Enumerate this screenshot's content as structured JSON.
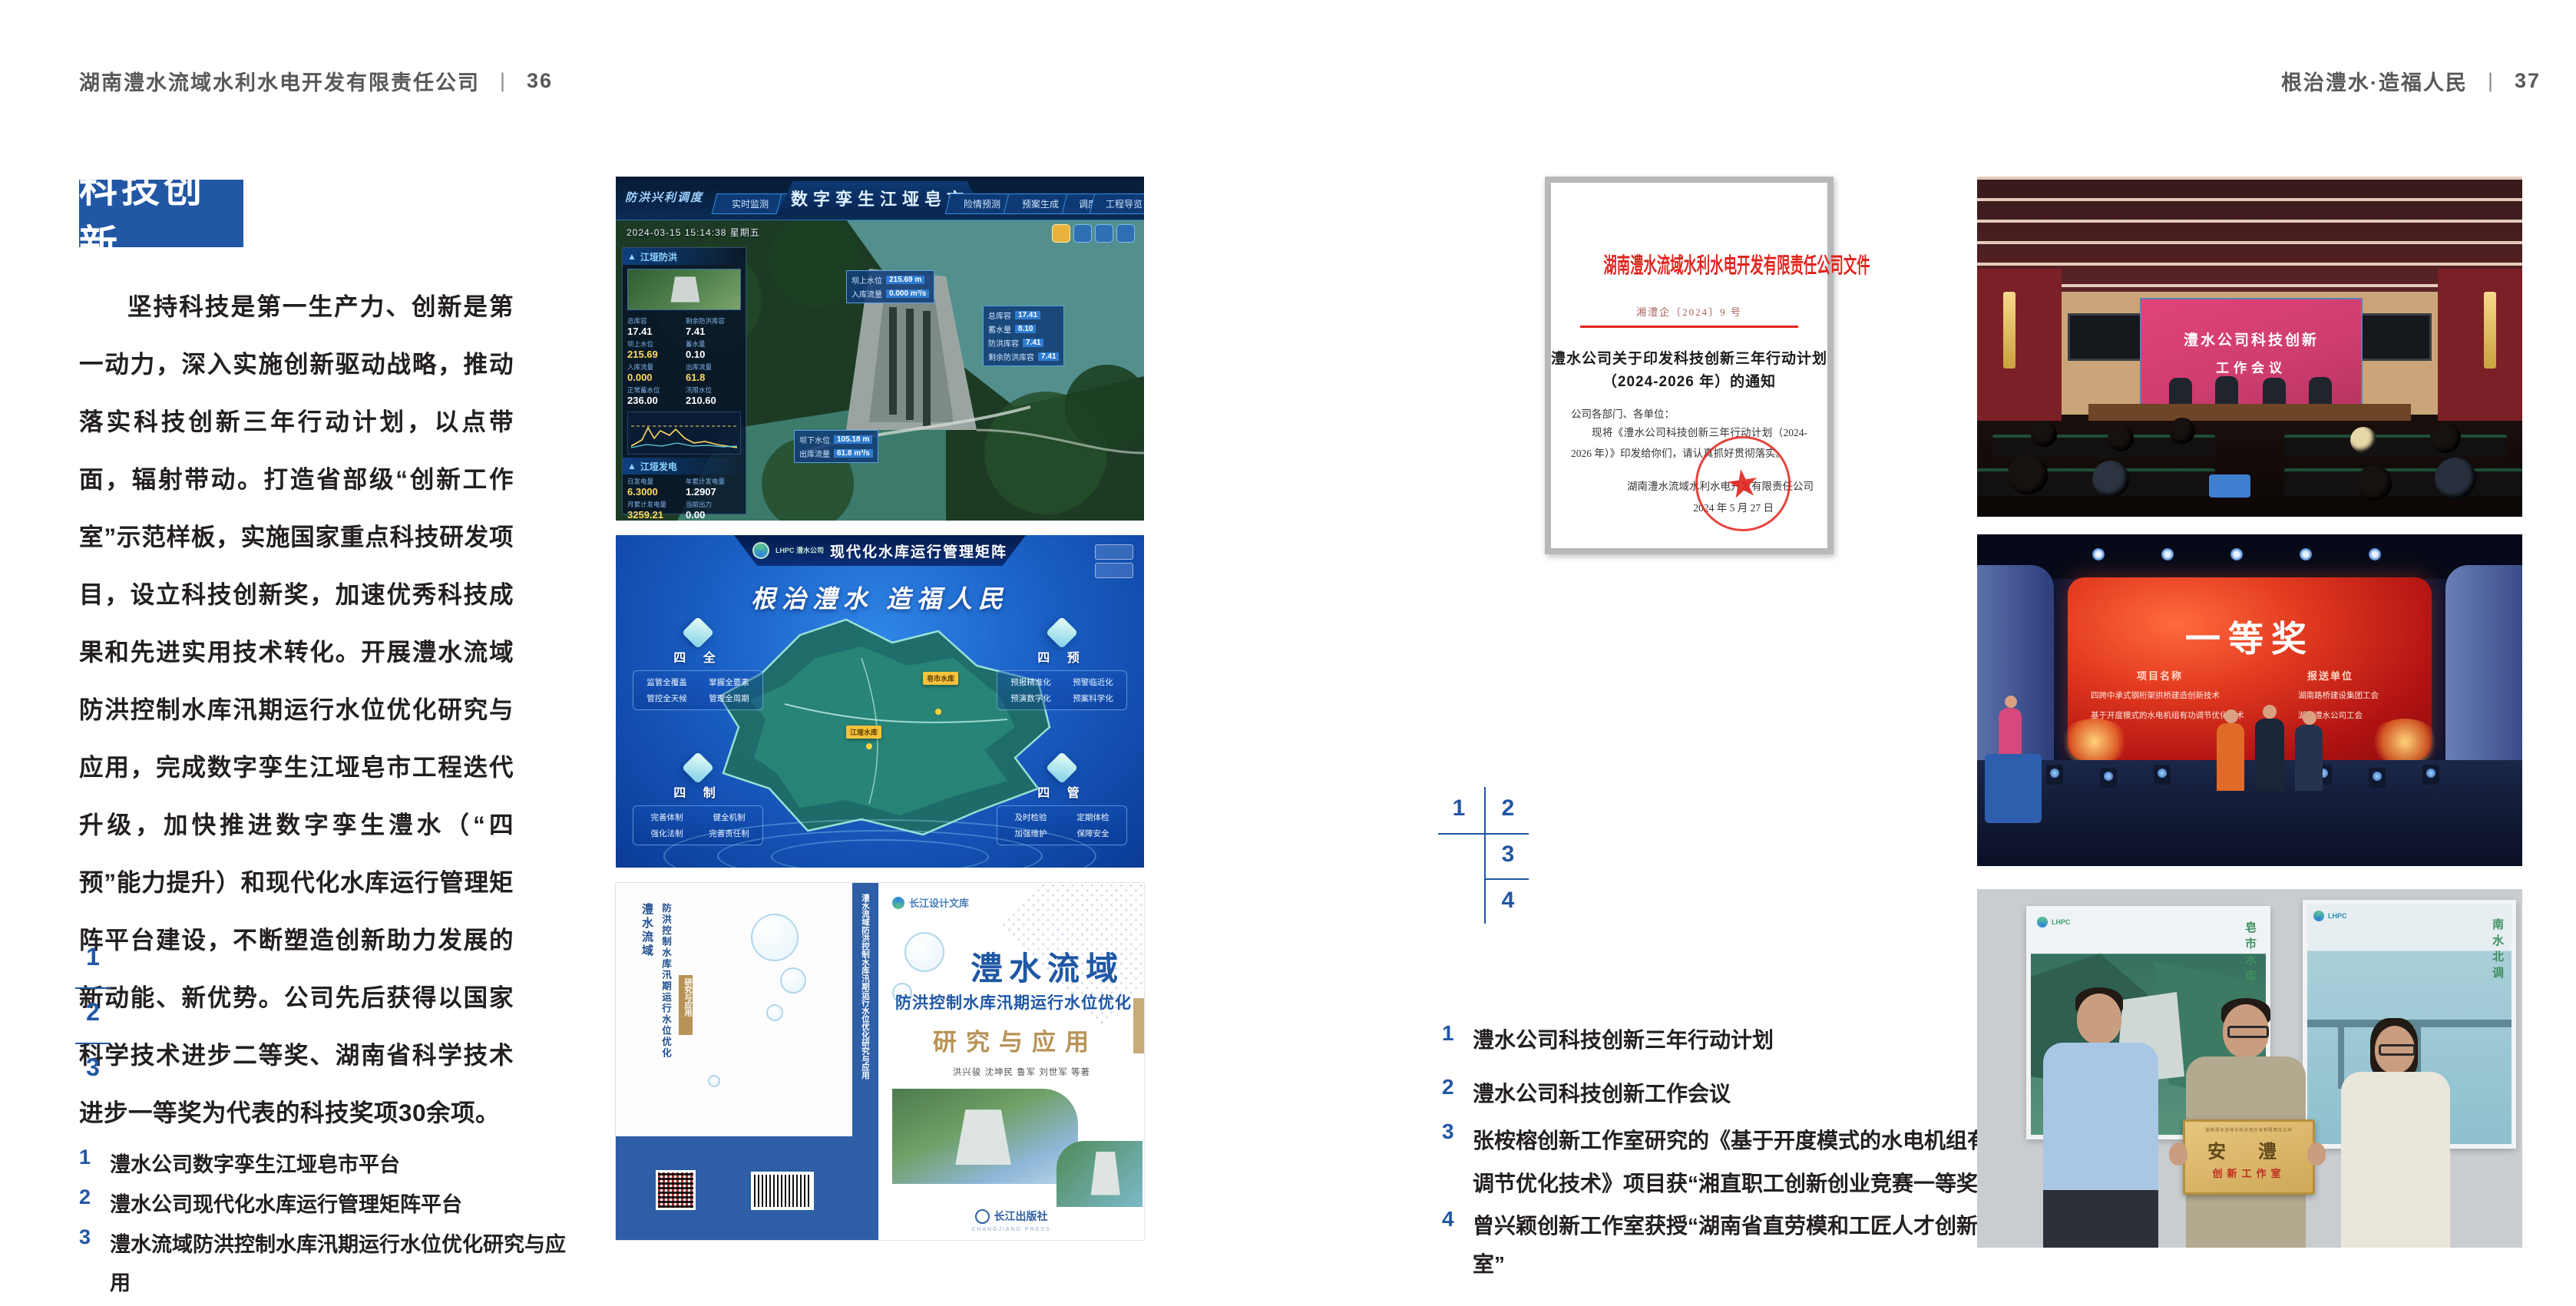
{
  "colors": {
    "accent": "#2257a4",
    "doc_red": "#e2241d",
    "text_dark": "#231f20",
    "header_gray": "#58595b",
    "gold": "#b89357"
  },
  "header_left": {
    "company": "湖南澧水流域水利水电开发有限责任公司",
    "sep": "|",
    "page": "36"
  },
  "header_right": {
    "title": "根治澧水·造福人民",
    "sep": "|",
    "page": "37"
  },
  "left_page": {
    "section_title": "科技创新",
    "body": "坚持科技是第一生产力、创新是第一动力，深入实施创新驱动战略，推动落实科技创新三年行动计划，以点带面，辐射带动。打造省部级“创新工作室”示范样板，实施国家重点科技研发项目，设立科技创新奖，加速优秀科技成果和先进实用技术转化。开展澧水流域防洪控制水库汛期运行水位优化研究与应用，完成数字孪生江垭皂市工程迭代升级，加快推进数字孪生澧水（“四预”能力提升）和现代化水库运行管理矩阵平台建设，不断塑造创新助力发展的新动能、新优势。公司先后获得以国家科学技术进步二等奖、湖南省科学技术进步一等奖为代表的科技奖项30余项。",
    "figure_numbers": [
      "1",
      "2",
      "3"
    ],
    "captions": [
      {
        "num": "1",
        "text": "澧水公司数字孪生江垭皂市平台"
      },
      {
        "num": "2",
        "text": "澧水公司现代化水库运行管理矩阵平台"
      },
      {
        "num": "3",
        "text": "澧水流域防洪控制水库汛期运行水位优化研究与应用"
      }
    ]
  },
  "right_page": {
    "figure_numbers": [
      "1",
      "2",
      "3",
      "4"
    ],
    "captions": [
      {
        "num": "1",
        "text": "澧水公司科技创新三年行动计划"
      },
      {
        "num": "2",
        "text": "澧水公司科技创新工作会议"
      },
      {
        "num": "3",
        "text": "张桉榕创新工作室研究的《基于开度模式的水电机组有功调节优化技术》项目获“湘直职工创新创业竞赛一等奖”"
      },
      {
        "num": "4",
        "text": "曾兴颖创新工作室获授“湖南省直劳模和工匠人才创新工作室”"
      }
    ]
  },
  "dashboard": {
    "brand": "防洪兴利调度",
    "title": "数字孪生江垭皂市",
    "tabs_left": [
      "实时监测",
      "洪水预报",
      "防洪预警"
    ],
    "tabs_right": [
      "险情预测",
      "预案生成",
      "调度执行",
      "工程导览"
    ],
    "datetime": "2024-03-15 15:14:38 星期五",
    "panel_flood": {
      "title": "江垭防洪",
      "stats": [
        {
          "l": "总库容",
          "v": "17.41"
        },
        {
          "l": "剩余防洪库容",
          "v": "7.41"
        },
        {
          "l": "坝上水位",
          "v": "215.69"
        },
        {
          "l": "蓄水量",
          "v": "0.10"
        },
        {
          "l": "入库流量",
          "v": "0.000"
        },
        {
          "l": "出库流量",
          "v": "61.8"
        },
        {
          "l": "正常蓄水位",
          "v": "236.00"
        },
        {
          "l": "汛限水位",
          "v": "210.60"
        }
      ]
    },
    "panel_power": {
      "title": "江垭发电",
      "stats": [
        {
          "l": "日发电量",
          "v": "6.3000"
        },
        {
          "l": "年累计发电量",
          "v": "1.2907"
        },
        {
          "l": "月累计发电量",
          "v": "3259.21"
        },
        {
          "l": "当前出力",
          "v": "0.00"
        },
        {
          "l": "发电流量",
          "v": "0.00"
        },
        {
          "l": "弃水流量",
          "v": "0.00"
        }
      ],
      "units": [
        "1号机",
        "2号机",
        "3号机"
      ]
    },
    "tooltip_up": [
      {
        "l": "坝上水位",
        "v": "215.69 m"
      },
      {
        "l": "入库流量",
        "v": "0.000 m³/s"
      }
    ],
    "tooltip_cap": [
      {
        "l": "总库容",
        "v": "17.41"
      },
      {
        "l": "蓄水量",
        "v": "8.10"
      },
      {
        "l": "防洪库容",
        "v": "7.41"
      },
      {
        "l": "剩余防洪库容",
        "v": "7.41"
      }
    ],
    "tooltip_down": [
      {
        "l": "坝下水位",
        "v": "105.18 m"
      },
      {
        "l": "出库流量",
        "v": "61.8 m³/s"
      }
    ]
  },
  "matrix": {
    "logo": "LHPC 澧水公司",
    "title": "现代化水库运行管理矩阵",
    "slogan": "根治澧水 造福人民",
    "groups": [
      {
        "name": "四 全",
        "items": [
          "监管全覆盖",
          "掌握全要素",
          "管控全天候",
          "管理全周期"
        ]
      },
      {
        "name": "四 预",
        "items": [
          "预报精准化",
          "预警临近化",
          "预演数字化",
          "预案科学化"
        ]
      },
      {
        "name": "四 制",
        "items": [
          "完善体制",
          "健全机制",
          "强化法制",
          "完善责任制"
        ]
      },
      {
        "name": "四 管",
        "items": [
          "及时检验",
          "定期体检",
          "加强维护",
          "保障安全"
        ]
      }
    ],
    "map_labels": [
      "皂市水库",
      "江垭水库"
    ]
  },
  "book": {
    "series": "长江设计文库",
    "title_main": "澧水流域",
    "title_sub": "防洪控制水库汛期运行水位优化",
    "title_tail": "研究与应用",
    "authors": "洪兴骏 沈坤民 鲁军 刘世军 等著",
    "publisher": "长江出版社",
    "publisher_en": "CHANGJIANG PRESS",
    "spine_text": "澧水流域防洪控制水库汛期运行水位优化研究与应用"
  },
  "document": {
    "header": "湖南澧水流域水利水电开发有限责任公司文件",
    "doc_no": "湘澧企〔2024〕9 号",
    "title_line1": "澧水公司关于印发科技创新三年行动计划",
    "title_line2": "（2024-2026 年）的通知",
    "salutation": "公司各部门、各单位：",
    "body": "现将《澧水公司科技创新三年行动计划（2024-2026 年）》印发给你们，请认真抓好贯彻落实。",
    "signer": "湖南澧水流域水利水电开发有限责任公司",
    "date": "2024 年 5 月 27 日"
  },
  "meeting": {
    "screen_line1": "澧水公司科技创新",
    "screen_line2": "工作会议"
  },
  "stage": {
    "award": "一等奖",
    "col1_header": "项目名称",
    "col2_header": "报送单位",
    "col1_rows": [
      "四跨中承式钢桁架拱桥建造创新技术",
      "基于开度模式的水电机组有功调节优化技术"
    ],
    "col2_rows": [
      "湖南路桥建设集团工会",
      "湖南澧水公司工会"
    ]
  },
  "group_photo": {
    "plaque_header": "湖南澧水流域水利水电开发有限责任公司",
    "plaque_main": "安 澧",
    "plaque_sub": "创新工作室",
    "poster_left_text": "皂市水库",
    "poster_right_text": "南水北调"
  }
}
